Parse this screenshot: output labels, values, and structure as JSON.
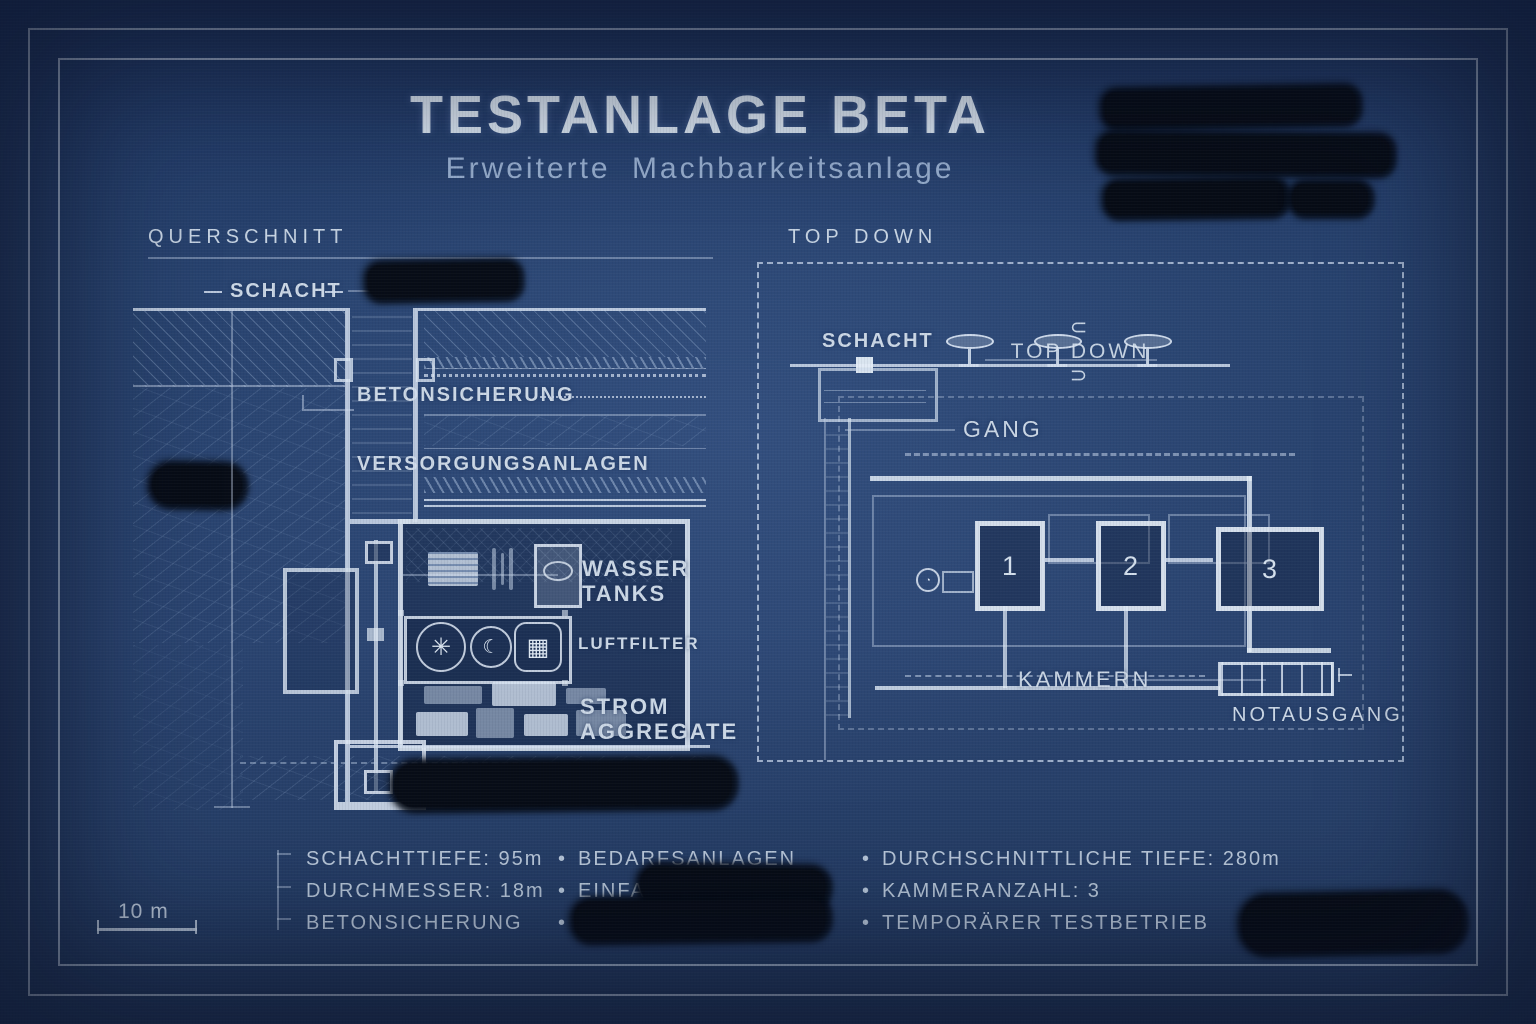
{
  "title": {
    "main": "TESTANLAGE BETA",
    "subtitle": "Erweiterte Machbarkeitsanlage"
  },
  "sections": {
    "querschnitt": {
      "heading": "QUERSCHNITT",
      "labels": {
        "schacht": "SCHACHT",
        "betonsicherung": "BETONSICHERUNG",
        "versorgungsanlagen": "VERSORGUNGSANLAGEN",
        "wasser_tanks": "WASSER\nTANKS",
        "luftfilter": "LUFTFILTER",
        "strom_aggregate": "STROM\nAGGREGATE"
      }
    },
    "topdown": {
      "heading": "TOP DOWN",
      "compass": {
        "left": "⊂",
        "label": "TOP DOWN",
        "right": "⊃"
      },
      "labels": {
        "schacht": "SCHACHT",
        "gang": "GANG",
        "kammern": "KAMMERN",
        "notausgang": "NOTAUSGANG"
      },
      "chambers": [
        "1",
        "2",
        "3"
      ]
    }
  },
  "legend": {
    "bullet": "•",
    "col1": [
      "SCHACHTTIEFE: 95m",
      "DURCHMESSER: 18m",
      "BETONSICHERUNG"
    ],
    "col2": [
      "BEDARFSANLAGEN",
      "EINFACHE A",
      ""
    ],
    "col3": [
      "DURCHSCHNITTLICHE TIEFE: 280m",
      "KAMMERANZAHL: 3",
      "TEMPORÄRER TESTBETRIEB"
    ]
  },
  "scale_bar": {
    "label": "10 m"
  },
  "icons": {
    "fan": "✳",
    "crescent": "☾",
    "filter_unit": "▦"
  },
  "colors": {
    "background": "#28436f",
    "line": "#cdd9e6",
    "text": "#bac9db",
    "redaction": "#070c16"
  }
}
